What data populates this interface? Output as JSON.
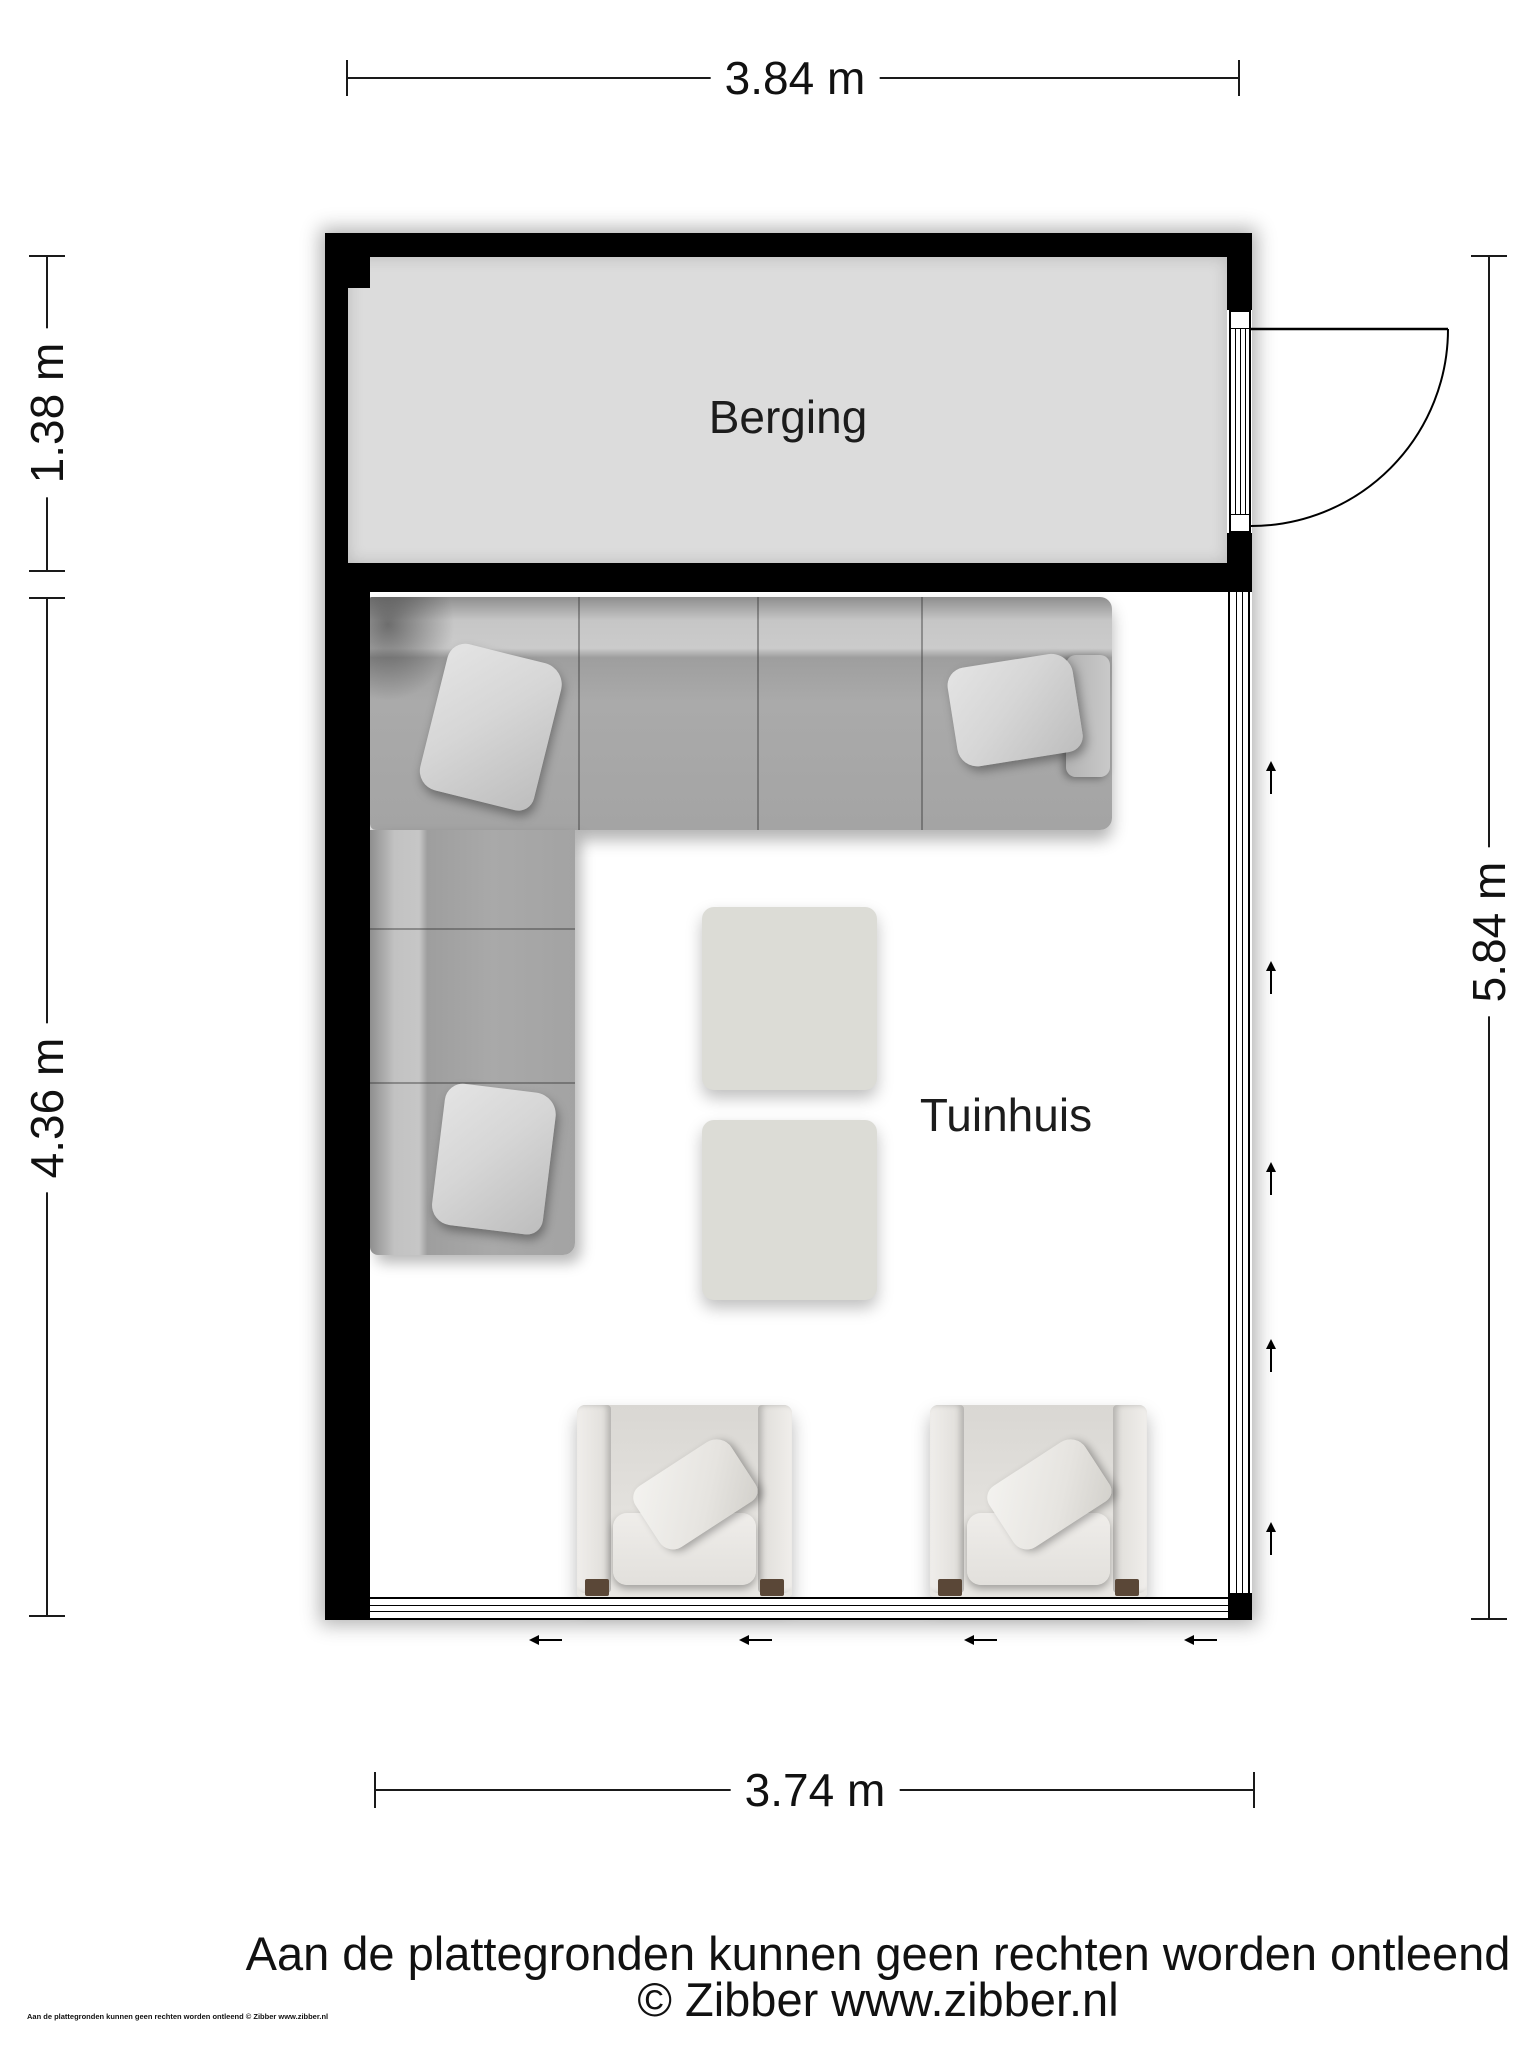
{
  "page": {
    "width": 1536,
    "height": 2048,
    "background": "#ffffff"
  },
  "plan": {
    "type": "floorplan",
    "rooms": [
      {
        "id": "berging",
        "label": "Berging"
      },
      {
        "id": "tuinhuis",
        "label": "Tuinhuis"
      }
    ],
    "dimensions": {
      "top": {
        "label": "3.84 m",
        "orientation": "horizontal"
      },
      "left_upper": {
        "label": "1.38 m",
        "orientation": "vertical"
      },
      "left_lower": {
        "label": "4.36 m",
        "orientation": "vertical"
      },
      "right": {
        "label": "5.84 m",
        "orientation": "vertical"
      },
      "bottom": {
        "label": "3.74 m",
        "orientation": "horizontal"
      }
    },
    "features": {
      "berging_door": "single swing door opening outward on right wall of Berging",
      "right_window_arrows": 5,
      "bottom_window_arrows": 4
    },
    "colors": {
      "wall": "#000000",
      "berging_floor": "#dcdcdc",
      "tuinhuis_floor": "#ffffff",
      "sofa_body": "#a9a9a9",
      "sofa_back": "#c8c8c8",
      "pillow": "#d9d9d9",
      "table": "#dcdcd6",
      "chair": "#e5e3df",
      "chair_foot": "#5a4737",
      "dimension_line": "#1a1a1a"
    }
  },
  "footer": {
    "disclaimer": "Aan de plattegronden kunnen geen rechten worden ontleend",
    "copyright": "© Zibber www.zibber.nl",
    "small_print": "Aan de plattegronden kunnen geen rechten worden ontleend © Zibber www.zibber.nl"
  }
}
